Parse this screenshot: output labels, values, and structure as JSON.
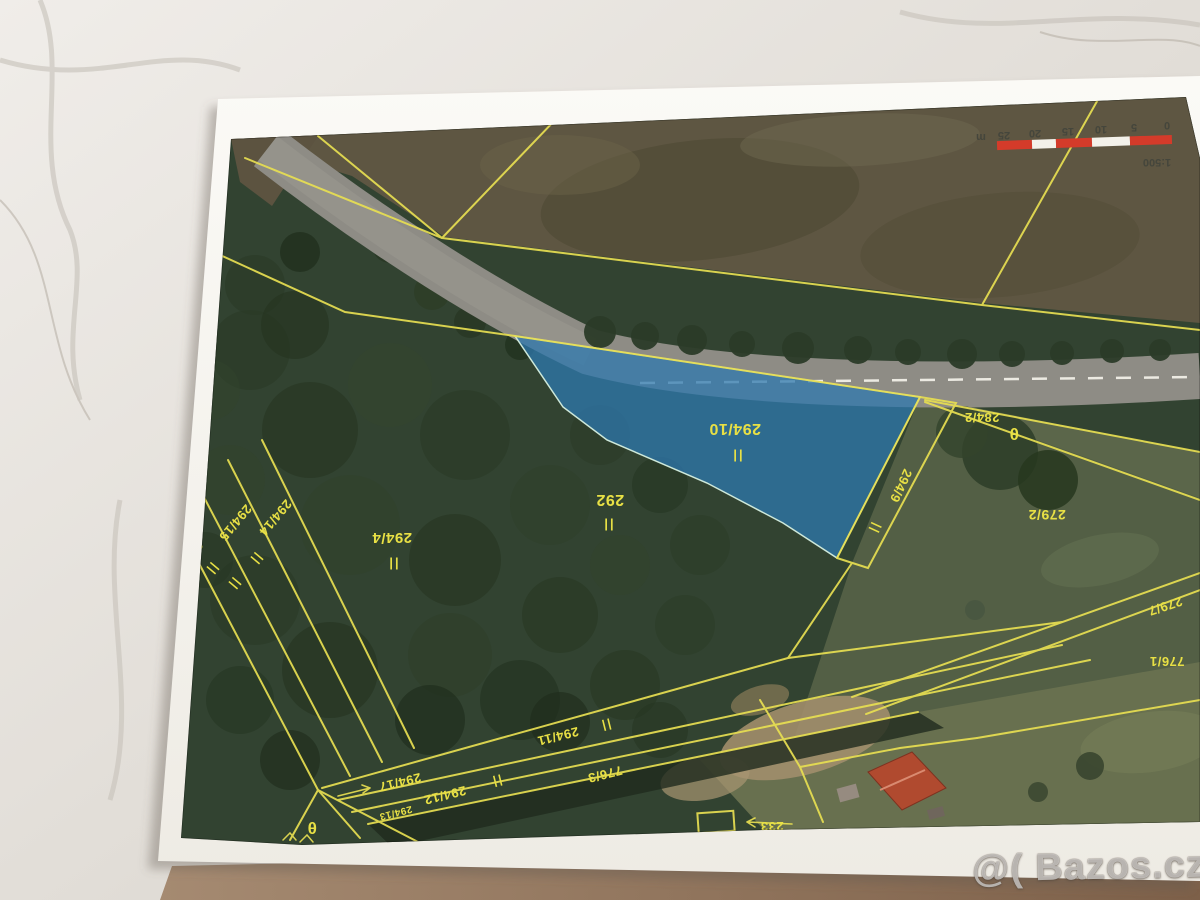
{
  "window": {
    "width": 1200,
    "height": 900
  },
  "watermark": {
    "text": "@( Bazos.cz"
  },
  "map": {
    "type": "cadastral-orthophoto",
    "orientation": "printed sheet rotated 180°, all map text upside down",
    "highlighted_parcel": {
      "number": "294/10",
      "fill": "#2d78af",
      "land_use_symbol": "||"
    },
    "line_color": "#e8df52",
    "label_color": "#e8e045",
    "scale": {
      "ratio_label": "1:500",
      "tick_labels": [
        "0",
        "5",
        "10",
        "15",
        "20",
        "25",
        "m"
      ],
      "bar_colors": {
        "red": "#d43b2a",
        "white": "#f3f1ea"
      }
    },
    "labels": [
      {
        "name": "parcel-label-294-10",
        "text": "294/10",
        "x": 735,
        "y": 424,
        "rot": 180,
        "size": 16
      },
      {
        "name": "grassland-symbol",
        "text": "||",
        "x": 737,
        "y": 452,
        "rot": 180,
        "size": 13,
        "cls": "gsym"
      },
      {
        "name": "parcel-label-292",
        "text": "292",
        "x": 610,
        "y": 495,
        "rot": 180,
        "size": 16
      },
      {
        "name": "grassland-symbol",
        "text": "||",
        "x": 608,
        "y": 521,
        "rot": 180,
        "size": 13,
        "cls": "gsym"
      },
      {
        "name": "parcel-label-294-4",
        "text": "294/4",
        "x": 392,
        "y": 533,
        "rot": 180,
        "size": 15
      },
      {
        "name": "grassland-symbol",
        "text": "||",
        "x": 393,
        "y": 560,
        "rot": 180,
        "size": 13,
        "cls": "gsym"
      },
      {
        "name": "parcel-label-294-15",
        "text": "294/15",
        "x": 232,
        "y": 520,
        "rot": 130,
        "size": 13
      },
      {
        "name": "parcel-label-294-14",
        "text": "294/14",
        "x": 272,
        "y": 515,
        "rot": 130,
        "size": 13
      },
      {
        "name": "parcel-label-partial-29",
        "text": "29",
        "x": 192,
        "y": 546,
        "rot": 130,
        "size": 13
      },
      {
        "name": "grassland-symbol",
        "text": "||",
        "x": 210,
        "y": 567,
        "rot": 130,
        "size": 12,
        "cls": "gsym"
      },
      {
        "name": "grassland-symbol",
        "text": "||",
        "x": 232,
        "y": 582,
        "rot": 130,
        "size": 12,
        "cls": "gsym"
      },
      {
        "name": "grassland-symbol",
        "text": "||",
        "x": 254,
        "y": 557,
        "rot": 130,
        "size": 12,
        "cls": "gsym"
      },
      {
        "name": "parcel-label-294-9",
        "text": "294/9",
        "x": 897,
        "y": 484,
        "rot": 115,
        "size": 13
      },
      {
        "name": "grassland-symbol",
        "text": "||",
        "x": 872,
        "y": 527,
        "rot": 115,
        "size": 12,
        "cls": "gsym"
      },
      {
        "name": "parcel-label-284-2",
        "text": "284/2",
        "x": 982,
        "y": 413,
        "rot": 180,
        "size": 13
      },
      {
        "name": "theta-symbol",
        "text": "θ",
        "x": 1014,
        "y": 428,
        "rot": 180,
        "size": 17
      },
      {
        "name": "parcel-label-279-2",
        "text": "279/2",
        "x": 1047,
        "y": 510,
        "rot": 180,
        "size": 14
      },
      {
        "name": "parcel-label-279-7",
        "text": "279/7",
        "x": 1164,
        "y": 602,
        "rot": 162,
        "size": 13
      },
      {
        "name": "parcel-label-776-1",
        "text": "776/1",
        "x": 1167,
        "y": 657,
        "rot": 180,
        "size": 13
      },
      {
        "name": "parcel-label-294-11",
        "text": "294/11",
        "x": 557,
        "y": 732,
        "rot": 166,
        "size": 13
      },
      {
        "name": "grassland-symbol",
        "text": "||",
        "x": 605,
        "y": 722,
        "rot": 166,
        "size": 12,
        "cls": "gsym"
      },
      {
        "name": "parcel-label-294-17",
        "text": "294/17",
        "x": 399,
        "y": 778,
        "rot": 166,
        "size": 13
      },
      {
        "name": "parcel-label-294-12",
        "text": "294/12",
        "x": 444,
        "y": 791,
        "rot": 166,
        "size": 13
      },
      {
        "name": "grassland-symbol",
        "text": "||",
        "x": 496,
        "y": 778,
        "rot": 166,
        "size": 12,
        "cls": "gsym"
      },
      {
        "name": "parcel-label-776-3",
        "text": "776/3",
        "x": 604,
        "y": 770,
        "rot": 166,
        "size": 13
      },
      {
        "name": "parcel-label-294-13",
        "text": "294/13",
        "x": 395,
        "y": 810,
        "rot": 166,
        "size": 10
      },
      {
        "name": "parcel-label-233",
        "text": "233",
        "x": 772,
        "y": 822,
        "rot": 180,
        "size": 13
      },
      {
        "name": "theta-symbol",
        "text": "θ",
        "x": 312,
        "y": 822,
        "rot": 180,
        "size": 17
      },
      {
        "name": "scale-tick",
        "text": "0",
        "x": 1167,
        "y": 122,
        "rot": 180,
        "size": 11,
        "cls": "tick"
      },
      {
        "name": "scale-tick",
        "text": "5",
        "x": 1134,
        "y": 124,
        "rot": 180,
        "size": 11,
        "cls": "tick"
      },
      {
        "name": "scale-tick",
        "text": "10",
        "x": 1101,
        "y": 126,
        "rot": 180,
        "size": 11,
        "cls": "tick"
      },
      {
        "name": "scale-tick",
        "text": "15",
        "x": 1068,
        "y": 128,
        "rot": 180,
        "size": 11,
        "cls": "tick"
      },
      {
        "name": "scale-tick",
        "text": "20",
        "x": 1035,
        "y": 130,
        "rot": 180,
        "size": 11,
        "cls": "tick"
      },
      {
        "name": "scale-tick",
        "text": "25",
        "x": 1004,
        "y": 132,
        "rot": 180,
        "size": 11,
        "cls": "tick"
      },
      {
        "name": "scale-tick",
        "text": "m",
        "x": 981,
        "y": 134,
        "rot": 180,
        "size": 11,
        "cls": "tick"
      },
      {
        "name": "scale-ratio",
        "text": "1:500",
        "x": 1157,
        "y": 159,
        "rot": 180,
        "size": 11,
        "cls": "tick"
      }
    ]
  }
}
